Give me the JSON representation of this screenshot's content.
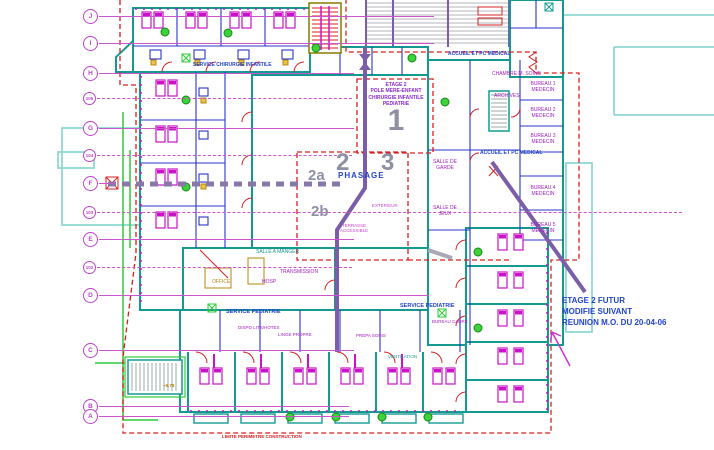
{
  "drawing_type": "hospital floor plan - CAD",
  "colors": {
    "wall_teal": "#159a92",
    "partition_blue": "#2b35c8",
    "door_red": "#d62020",
    "bed_magenta": "#c813c8",
    "plant_green": "#2ecc38",
    "grid_magenta": "#bb44cc",
    "phase_purple": "#7b5ea7",
    "note_blue": "#2244cc",
    "boundary_red": "#d62020",
    "overlay_cyan": "#8fd8d4",
    "phase_number_gray": "#8f8fa5"
  },
  "grid": {
    "rows": [
      "J",
      "I",
      "H",
      "105",
      "G",
      "104",
      "F",
      "103",
      "E",
      "102",
      "D",
      "C",
      "B",
      "A"
    ]
  },
  "phase": {
    "zone1": "1",
    "zone2": "2",
    "zone3": "3",
    "zone2a": "2a",
    "zone2b": "2b",
    "phasage_label": "PHASAGE"
  },
  "title_block": {
    "lines": [
      "ETAGE 2",
      "POLE MERE-ENFANT",
      "CHIRURGIE INFANTILE",
      "PEDIATRIE"
    ]
  },
  "revision_note": {
    "lines": [
      "ETAGE 2  FUTUR",
      "MODIFIE SUIVANT",
      "REUNION M.O. DU 20-04-06"
    ]
  },
  "labels": {
    "service_chirurgie": "SERVICE CHIRURGIE INFANTILE",
    "accueil_top": "ACCUEIL ET PC MEDICAL",
    "accueil_mid": "ACCUEIL ET PC MEDICAL",
    "service_pediatrie_left": "SERVICE PEDIATRIE",
    "service_pediatrie_right": "SERVICE PEDIATRIE",
    "chambre_soins": "CHAMBRE M. SOINS",
    "archives": "ARCHIVES",
    "bureau1": "BUREAU 1 MEDECIN",
    "bureau2": "BUREAU 2 MEDECIN",
    "bureau3": "BUREAU 3 MEDECIN",
    "bureau4": "BUREAU 4 MEDECIN",
    "bureau5": "BUREAU 5 MEDECIN",
    "salle_de_garde": "SALLE DE GARDE",
    "salle_de_jeux": "SALLE DE JEUX",
    "salle_a_manger": "SALLE A MANGER",
    "transmission": "TRANSMISSION",
    "office": "OFFICE",
    "hosp": "HOSP",
    "dispo_lits": "DISPO LITS/HOTES",
    "linge_propre": "LINGE PROPRE",
    "prepa_soins": "PREPA SOINS",
    "bureau_cadre": "BUREAU CADRE",
    "ventilation": "VENTILATION",
    "exterieur": "EXTERIEUR",
    "terrasse": "TERRASSE ACCESSIBLE",
    "limite": "LIMITE PERIMETRE CONSTRUCTION",
    "niveau": "+6.78"
  }
}
